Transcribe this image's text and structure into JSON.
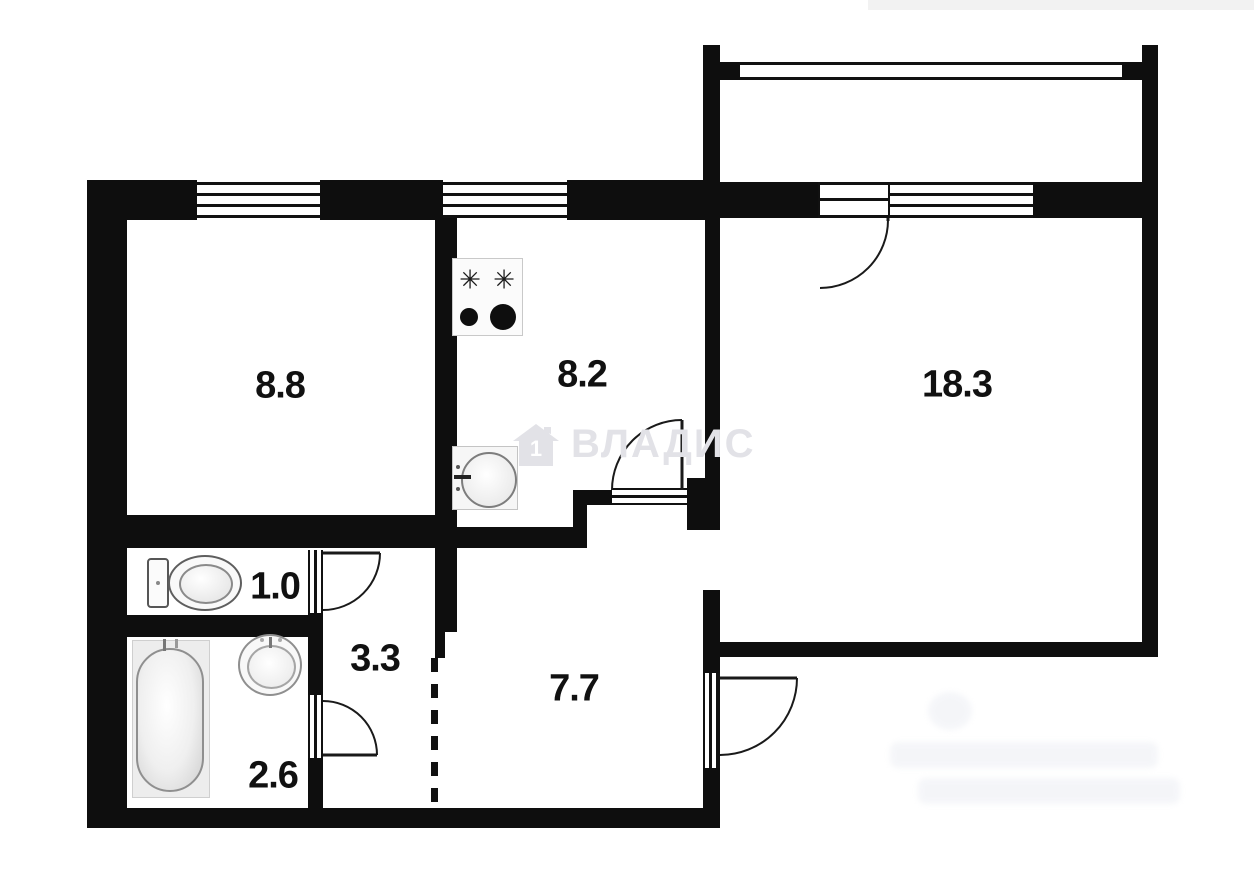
{
  "plan": {
    "type": "apartment-floor-plan",
    "units": "square meters",
    "rooms": {
      "bedroom": {
        "label": "8.8"
      },
      "kitchen": {
        "label": "8.2"
      },
      "living": {
        "label": "18.3"
      },
      "wc": {
        "label": "1.0"
      },
      "corridor": {
        "label": "3.3"
      },
      "bathroom": {
        "label": "2.6"
      },
      "hall": {
        "label": "7.7"
      }
    }
  },
  "fixtures": {
    "stove": {
      "burner_star": "✳"
    }
  },
  "watermark": {
    "text": "ВЛАДИС",
    "house_digit": "1",
    "color": "#e2e2e7"
  },
  "colors": {
    "wall": "#0e0e0e",
    "line": "#1a1a1a",
    "background": "#ffffff"
  }
}
